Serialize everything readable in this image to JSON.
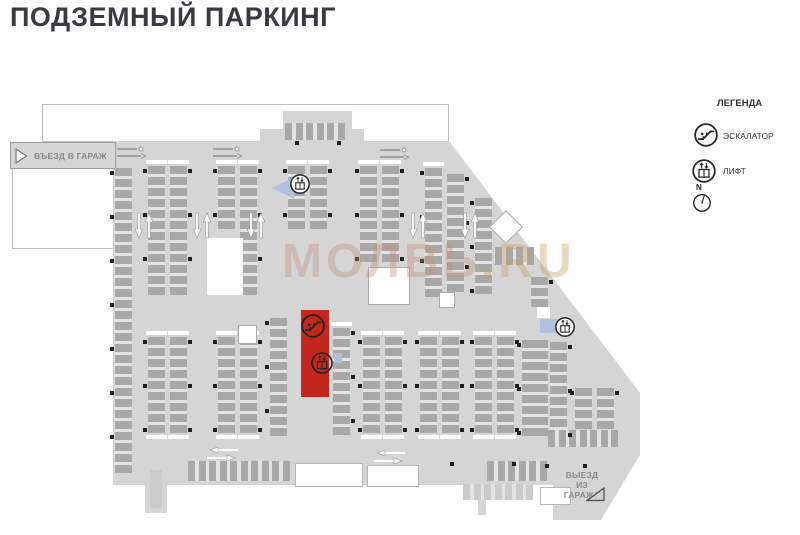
{
  "title": "ПОДЗЕМНЫЙ ПАРКИНГ",
  "watermark": {
    "part1": "МОЛВЬ",
    "part2": ".RU"
  },
  "entrance_label": "ВЪЕЗД В ГАРАЖ",
  "exit_label_lines": [
    "ВЫЕЗД",
    "ИЗ",
    "ГАРАЖА"
  ],
  "legend": {
    "heading": "ЛЕГЕНДА",
    "items": [
      {
        "icon": "escalator",
        "label": "ЭСКАЛАТОР"
      },
      {
        "icon": "lift",
        "label": "ЛИФТ"
      }
    ],
    "compass_label": "N"
  },
  "colors": {
    "plan_fill": "#d5d5d5",
    "stall": "#a8a8a8",
    "stall_gap": "#e3e3e3",
    "stall_light": "#cbcbcb",
    "pillar": "#1f1f1f",
    "highlight_red": "#c4281c",
    "marker_blue": "#b3c0dc",
    "label_gray": "#8a8a8a",
    "icon_stroke": "#222222"
  },
  "plan": {
    "strips": [
      {
        "x": 115,
        "y": 168,
        "c": 28,
        "ps": "l"
      },
      {
        "x": 148,
        "y": 166,
        "c": 12,
        "ps": "l",
        "cap": 1
      },
      {
        "x": 170,
        "y": 166,
        "c": 12,
        "ps": "r",
        "cap": 1
      },
      {
        "x": 218,
        "y": 166,
        "c": 6,
        "ps": "l",
        "cap": 1
      },
      {
        "x": 240,
        "y": 166,
        "c": 12,
        "ps": "r",
        "cap": 1
      },
      {
        "x": 288,
        "y": 166,
        "c": 6,
        "ps": "l",
        "cap": 1
      },
      {
        "x": 310,
        "y": 166,
        "c": 6,
        "ps": "r",
        "cap": 1
      },
      {
        "x": 360,
        "y": 166,
        "c": 9,
        "ps": "l",
        "cap": 1
      },
      {
        "x": 382,
        "y": 166,
        "c": 9,
        "ps": "r",
        "cap": 1
      },
      {
        "x": 425,
        "y": 168,
        "c": 12,
        "ps": "l",
        "cap": 1
      },
      {
        "x": 447,
        "y": 174,
        "c": 11,
        "ps": "r"
      },
      {
        "x": 475,
        "y": 198,
        "c": 9,
        "ps": "l"
      },
      {
        "x": 531,
        "y": 277,
        "c": 3,
        "ps": "r"
      },
      {
        "x": 550,
        "y": 342,
        "c": 9,
        "ps": "r"
      },
      {
        "x": 148,
        "y": 337,
        "c": 9,
        "ps": "l",
        "cap": 3
      },
      {
        "x": 170,
        "y": 337,
        "c": 9,
        "ps": "r",
        "cap": 3
      },
      {
        "x": 218,
        "y": 337,
        "c": 9,
        "ps": "l",
        "cap": 3
      },
      {
        "x": 240,
        "y": 337,
        "c": 9,
        "ps": "r",
        "cap": 3
      },
      {
        "x": 270,
        "y": 318,
        "c": 11,
        "ps": "l"
      },
      {
        "x": 333,
        "y": 328,
        "c": 10,
        "ps": "r",
        "cap": 1
      },
      {
        "x": 363,
        "y": 337,
        "c": 9,
        "ps": "l",
        "cap": 3
      },
      {
        "x": 385,
        "y": 337,
        "c": 9,
        "ps": "r",
        "cap": 3
      },
      {
        "x": 420,
        "y": 337,
        "c": 9,
        "ps": "l",
        "cap": 3
      },
      {
        "x": 442,
        "y": 337,
        "c": 9,
        "ps": "r",
        "cap": 3
      },
      {
        "x": 475,
        "y": 337,
        "c": 9,
        "ps": "l",
        "cap": 3
      },
      {
        "x": 497,
        "y": 337,
        "c": 9,
        "ps": "r",
        "cap": 3
      },
      {
        "x": 522,
        "y": 340,
        "c": 9,
        "w": 26,
        "ps": "l"
      },
      {
        "x": 575,
        "y": 388,
        "c": 4,
        "ps": "l"
      },
      {
        "x": 597,
        "y": 388,
        "c": 4,
        "ps": "r"
      },
      {
        "x": 285,
        "y": 123,
        "c": 6,
        "dir": "v",
        "bh": 17
      },
      {
        "x": 495,
        "y": 247,
        "c": 4,
        "dir": "v",
        "bh": 18
      },
      {
        "x": 188,
        "y": 461,
        "c": 10,
        "dir": "v",
        "bh": 20
      },
      {
        "x": 487,
        "y": 461,
        "c": 6,
        "dir": "v",
        "bh": 20
      },
      {
        "x": 548,
        "y": 430,
        "c": 7,
        "dir": "v",
        "bh": 17
      },
      {
        "x": 463,
        "y": 484,
        "c": 7,
        "dir": "v",
        "bh": 16,
        "shade": "light"
      }
    ],
    "cores": [
      {
        "x": 207,
        "y": 238,
        "w": 36,
        "h": 57,
        "b": 0
      },
      {
        "x": 368,
        "y": 267,
        "w": 40,
        "h": 36,
        "b": 1
      },
      {
        "x": 238,
        "y": 325,
        "w": 17,
        "h": 17,
        "b": 1
      },
      {
        "x": 439,
        "y": 292,
        "w": 14,
        "h": 14,
        "b": 1
      },
      {
        "x": 537,
        "y": 307,
        "w": 13,
        "h": 11,
        "b": 0
      },
      {
        "x": 494,
        "y": 215,
        "w": 22,
        "h": 22,
        "b": 1,
        "rot": 45
      }
    ],
    "cutouts": [
      {
        "x": 295,
        "y": 463,
        "w": 66,
        "h": 22
      },
      {
        "x": 367,
        "y": 465,
        "w": 50,
        "h": 20
      },
      {
        "x": 540,
        "y": 487,
        "w": 29,
        "h": 16
      }
    ],
    "protrusions": [
      {
        "x": 145,
        "y": 463,
        "w": 22,
        "h": 50
      },
      {
        "x": 478,
        "y": 485,
        "w": 8,
        "h": 30
      }
    ],
    "light_rects": [
      {
        "x": 150,
        "y": 470,
        "w": 12,
        "h": 38
      }
    ],
    "highlight": {
      "x": 301,
      "y": 310,
      "w": 28,
      "h": 87
    },
    "icons": [
      {
        "type": "escalator",
        "x": 313,
        "y": 326,
        "r": 13,
        "on": "red"
      },
      {
        "type": "lift",
        "x": 322,
        "y": 363,
        "r": 12,
        "on": "red"
      },
      {
        "type": "lift",
        "x": 300,
        "y": 184,
        "r": 11,
        "on": "white"
      },
      {
        "type": "lift",
        "x": 565,
        "y": 327,
        "r": 11,
        "on": "white"
      }
    ],
    "markers": [
      {
        "type": "tri-left",
        "x": 272,
        "y": 177,
        "w": 22,
        "h": 22
      },
      {
        "type": "rect",
        "x": 540,
        "y": 319,
        "w": 18,
        "h": 14
      },
      {
        "type": "rect",
        "x": 334,
        "y": 353,
        "w": 8,
        "h": 10
      }
    ],
    "varrows": [
      {
        "x": 134,
        "y": 212
      },
      {
        "x": 192,
        "y": 212
      },
      {
        "x": 246,
        "y": 212
      },
      {
        "x": 408,
        "y": 212
      },
      {
        "x": 460,
        "y": 212
      }
    ],
    "harrows": [
      {
        "x": 205,
        "y": 446
      },
      {
        "x": 372,
        "y": 449
      }
    ],
    "barriers": [
      {
        "x": 117,
        "y": 146
      },
      {
        "x": 213,
        "y": 146
      },
      {
        "x": 380,
        "y": 147
      }
    ],
    "pillars": [
      [
        545,
        464
      ],
      [
        583,
        464
      ],
      [
        295,
        141
      ],
      [
        337,
        141
      ],
      [
        450,
        462
      ],
      [
        512,
        462
      ]
    ]
  }
}
